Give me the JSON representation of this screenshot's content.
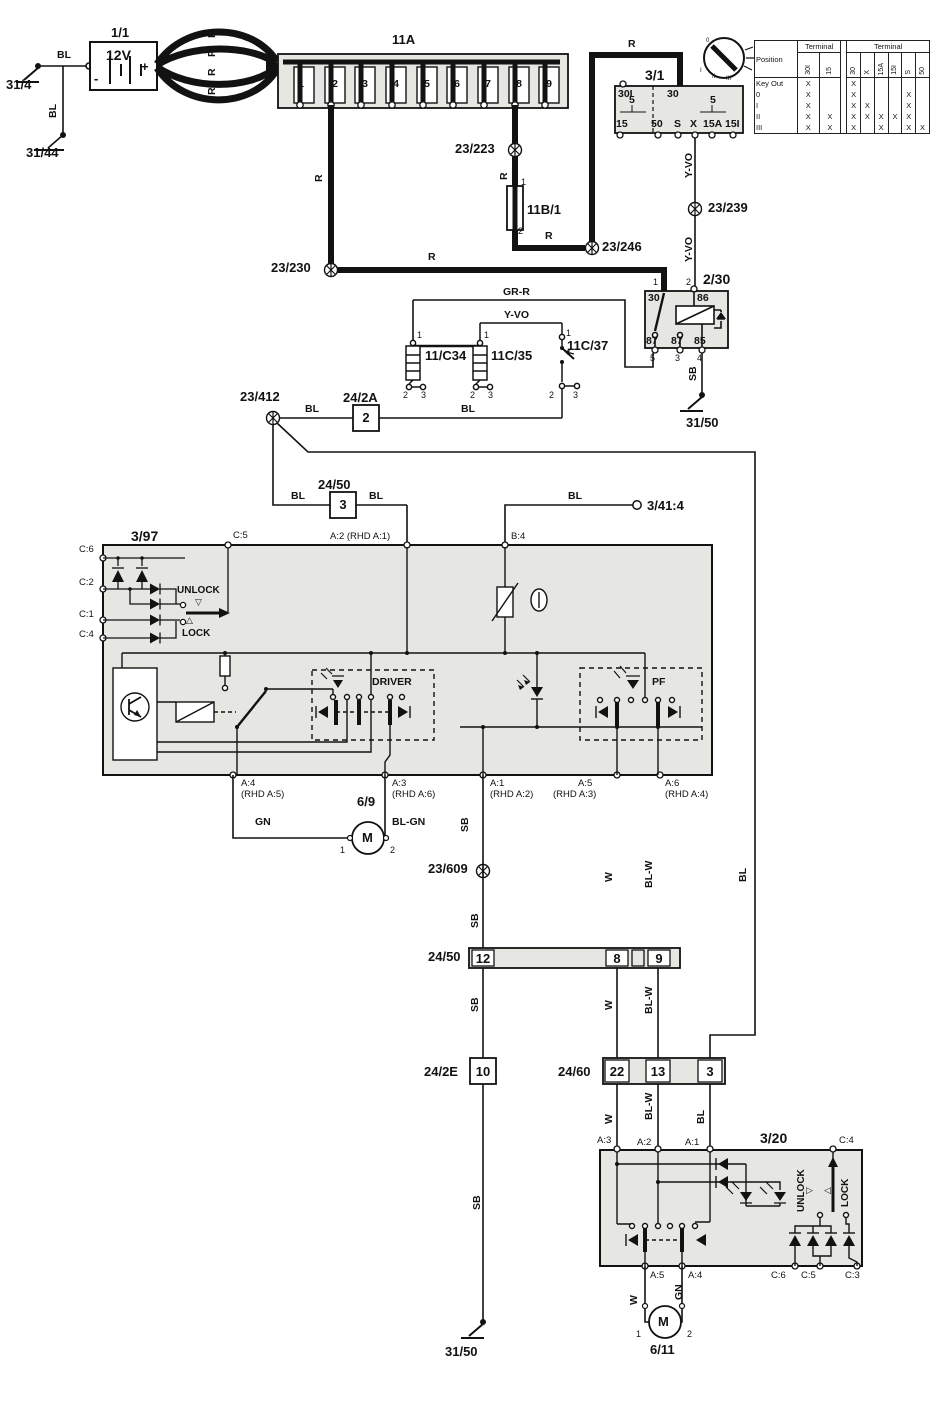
{
  "wire_colors": {
    "r": "R",
    "bl": "BL",
    "sb": "SB",
    "w": "W",
    "bl_w": "BL-W",
    "gn": "GN",
    "bl_gn": "BL-GN",
    "y_vo": "Y-VO",
    "gr_r": "GR-R"
  },
  "grounds": {
    "g31_4": "31/4",
    "g31_44": "31/44",
    "g31_50_relay": "31/50",
    "g31_50_bottom": "31/50"
  },
  "battery": {
    "id": "1/1",
    "voltage": "12V",
    "neg": "-",
    "pos": "+"
  },
  "fusebox": {
    "id": "11A",
    "fuses": [
      "1",
      "2",
      "3",
      "4",
      "5",
      "6",
      "7",
      "8",
      "9"
    ]
  },
  "fuse11b1": {
    "id": "11B/1",
    "pin1": "1",
    "pin2": "2"
  },
  "ignition": {
    "id": "3/1",
    "t_30i": "30I",
    "t_30": "30",
    "amp_left": "5",
    "amp_right": "5",
    "t_15": "15",
    "t_50": "50",
    "t_s": "S",
    "t_x": "X",
    "t_15a": "15A",
    "t_15i": "15I",
    "pos0": "0",
    "pos1": "I",
    "pos2": "II",
    "pos3": "III"
  },
  "key_table": {
    "h_position": "Position",
    "h_terminal_left": "Terminal",
    "h_terminal_right": "Terminal",
    "cols_left": [
      "30I",
      "15"
    ],
    "cols_right": [
      "30",
      "X",
      "15A",
      "15I",
      "S",
      "50"
    ],
    "rows": [
      {
        "label": "Key Out",
        "left": [
          "X",
          ""
        ],
        "right": [
          "X",
          "",
          "",
          "",
          "",
          ""
        ]
      },
      {
        "label": "0",
        "left": [
          "X",
          ""
        ],
        "right": [
          "X",
          "",
          "",
          "",
          "X",
          ""
        ]
      },
      {
        "label": "I",
        "left": [
          "X",
          ""
        ],
        "right": [
          "X",
          "X",
          "",
          "",
          "X",
          ""
        ]
      },
      {
        "label": "II",
        "left": [
          "X",
          "X"
        ],
        "right": [
          "X",
          "X",
          "X",
          "X",
          "X",
          ""
        ]
      },
      {
        "label": "III",
        "left": [
          "X",
          "X"
        ],
        "right": [
          "X",
          "",
          "X",
          "",
          "X",
          "X"
        ]
      }
    ]
  },
  "splices": {
    "s223": "23/223",
    "s230": "23/230",
    "s239": "23/239",
    "s246": "23/246",
    "s412": "23/412",
    "s609": "23/609"
  },
  "relay": {
    "id": "2/30",
    "p1": "1",
    "t30": "30",
    "p2": "2",
    "t86": "86",
    "t87a": "87",
    "p5": "5",
    "t87b": "87",
    "p3": "3",
    "t85": "85",
    "p4": "4"
  },
  "lamp34": {
    "id": "11/C34",
    "p1": "1",
    "p2": "2",
    "p3": "3"
  },
  "lamp35": {
    "id": "11C/35",
    "p1": "1",
    "p2": "2",
    "p3": "3"
  },
  "switch37": {
    "id": "11C/37",
    "p1": "1",
    "p2": "2",
    "p3": "3"
  },
  "conn24_2a": {
    "id": "24/2A",
    "pin": "2"
  },
  "conn24_50a": {
    "id": "24/50",
    "pin": "3"
  },
  "conn3_41": {
    "id": "3/41:4"
  },
  "unit397": {
    "id": "3/97",
    "c5": "C:5",
    "c6": "C:6",
    "c2": "C:2",
    "c1": "C:1",
    "c4": "C:4",
    "a2": "A:2 (RHD A:1)",
    "b4": "B:4",
    "unlock": "UNLOCK",
    "lock": "LOCK",
    "driver": "DRIVER",
    "pf": "PF",
    "a4": "A:4",
    "a4_rhd": "(RHD A:5)",
    "a3": "A:3",
    "a3_rhd": "(RHD A:6)",
    "a1": "A:1",
    "a1_rhd": "(RHD A:2)",
    "a5": "A:5",
    "a5_rhd": "(RHD A:3)",
    "a6": "A:6",
    "a6_rhd": "(RHD A:4)"
  },
  "motor69": {
    "id": "6/9",
    "label": "M",
    "p1": "1",
    "p2": "2"
  },
  "strip24_50": {
    "id": "24/50",
    "p12": "12",
    "p8": "8",
    "p9": "9"
  },
  "conn24_2e": {
    "id": "24/2E",
    "pin": "10"
  },
  "strip24_60": {
    "id": "24/60",
    "p22": "22",
    "p13": "13",
    "p3": "3"
  },
  "unit320": {
    "id": "3/20",
    "a3": "A:3",
    "a2": "A:2",
    "a1": "A:1",
    "c4": "C:4",
    "a5": "A:5",
    "a4": "A:4",
    "c6": "C:6",
    "c5": "C:5",
    "c3": "C:3",
    "unlock": "UNLOCK",
    "lock": "LOCK"
  },
  "motor611": {
    "id": "6/11",
    "label": "M",
    "p1": "1",
    "p2": "2"
  }
}
